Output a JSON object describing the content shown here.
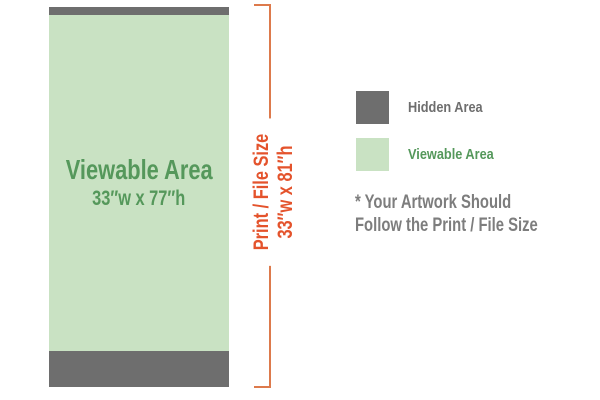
{
  "banner": {
    "viewable_area_label": "Viewable Area",
    "viewable_area_size": "33″w x 77″h"
  },
  "print_size": {
    "label": "Print / File Size",
    "size": "33″w x 81″h"
  },
  "legend": {
    "hidden": {
      "label": "Hidden Area",
      "color": "#6e6e6e"
    },
    "viewable": {
      "label": "Viewable Area",
      "color": "#c9e2c3"
    }
  },
  "note": {
    "line1": "* Your Artwork Should",
    "line2": "Follow the Print / File Size"
  },
  "colors": {
    "hidden_gray": "#6e6e6e",
    "viewable_green_fill": "#c9e2c3",
    "green_text": "#55985b",
    "orange_text": "#e4532c",
    "bracket_orange": "#dd7a4c",
    "note_gray": "#7d7d7d"
  }
}
